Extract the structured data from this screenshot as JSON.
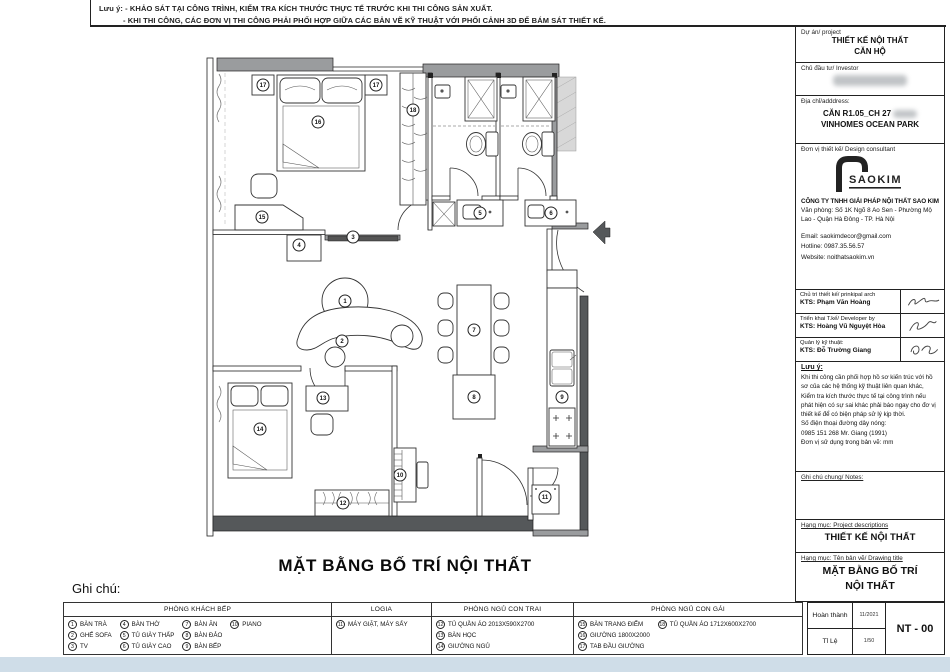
{
  "notes": {
    "line1": "Lưu ý: - KHẢO SÁT TẠI CÔNG TRÌNH, KIỂM TRA KÍCH THƯỚC THỰC TẾ TRƯỚC KHI THI CÔNG SẢN XUẤT.",
    "line2": "- KHI THI CÔNG, CÁC ĐƠN VỊ THI CÔNG PHẢI PHỐI HỢP GIỮA CÁC BẢN VẼ KỸ THUẬT VỚI PHỐI CẢNH 3D ĐỂ BÁM SÁT THIẾT KẾ."
  },
  "plan": {
    "title": "MẶT BẰNG BỐ TRÍ NỘI THẤT",
    "callouts": [
      {
        "n": "1",
        "x": 150,
        "y": 253
      },
      {
        "n": "2",
        "x": 147,
        "y": 293
      },
      {
        "n": "3",
        "x": 158,
        "y": 189
      },
      {
        "n": "4",
        "x": 104,
        "y": 197
      },
      {
        "n": "5",
        "x": 285,
        "y": 165
      },
      {
        "n": "6",
        "x": 356,
        "y": 165
      },
      {
        "n": "7",
        "x": 279,
        "y": 282
      },
      {
        "n": "8",
        "x": 279,
        "y": 349
      },
      {
        "n": "9",
        "x": 367,
        "y": 349
      },
      {
        "n": "10",
        "x": 205,
        "y": 427
      },
      {
        "n": "11",
        "x": 350,
        "y": 449
      },
      {
        "n": "12",
        "x": 148,
        "y": 455
      },
      {
        "n": "13",
        "x": 128,
        "y": 350
      },
      {
        "n": "14",
        "x": 65,
        "y": 381
      },
      {
        "n": "15",
        "x": 67,
        "y": 169
      },
      {
        "n": "16",
        "x": 123,
        "y": 74
      },
      {
        "n": "17",
        "x": 68,
        "y": 37
      },
      {
        "n": "17",
        "x": 181,
        "y": 37
      },
      {
        "n": "18",
        "x": 218,
        "y": 62
      }
    ]
  },
  "legend": {
    "title": "Ghi chú:",
    "groups": [
      {
        "header": "PHÒNG KHÁCH BẾP",
        "cols": [
          [
            {
              "n": "1",
              "label": "BÀN TRÀ"
            },
            {
              "n": "2",
              "label": "GHẾ SOFA"
            },
            {
              "n": "3",
              "label": "TV"
            }
          ],
          [
            {
              "n": "4",
              "label": "BÀN THỜ"
            },
            {
              "n": "5",
              "label": "TỦ GIÀY THẤP"
            },
            {
              "n": "6",
              "label": "TỦ GIÀY CAO"
            }
          ],
          [
            {
              "n": "7",
              "label": "BÀN ĂN"
            },
            {
              "n": "8",
              "label": "BÀN ĐẢO"
            },
            {
              "n": "9",
              "label": "BÀN BẾP"
            }
          ],
          [
            {
              "n": "10",
              "label": "PIANO"
            }
          ]
        ]
      },
      {
        "header": "LOGIA",
        "cols": [
          [
            {
              "n": "11",
              "label": "MÁY GIẶT, MÁY SẤY"
            }
          ]
        ]
      },
      {
        "header": "PHÒNG NGỦ CON TRAI",
        "cols": [
          [
            {
              "n": "12",
              "label": "TỦ QUẦN ÁO 2013X590X2700"
            },
            {
              "n": "13",
              "label": "BÀN HỌC"
            },
            {
              "n": "14",
              "label": "GIƯỜNG NGỦ"
            }
          ]
        ]
      },
      {
        "header": "PHÒNG NGỦ CON GÁI",
        "cols": [
          [
            {
              "n": "15",
              "label": "BÀN TRANG ĐIỂM"
            },
            {
              "n": "16",
              "label": "GIƯỜNG 1800X2000"
            },
            {
              "n": "17",
              "label": "TAB ĐẦU GIƯỜNG"
            }
          ],
          [
            {
              "n": "18",
              "label": "TỦ QUẦN ÁO 1712X600X2700"
            }
          ]
        ]
      }
    ]
  },
  "titleblock": {
    "project_label": "Dự án/ project",
    "project_line1": "THIẾT KẾ NỘI THẤT",
    "project_line2": "CĂN HỘ",
    "investor_label": "Chủ đầu tư/ Investor",
    "address_label": "Địa chỉ/adddress:",
    "address_line1": "CĂN R1.05_CH 27",
    "address_line2": "VINHOMES OCEAN PARK",
    "consultant_label": "Đơn vị thiết kế/ Design consultant",
    "logo_text": "SAOKIM",
    "company": "CÔNG TY TNHH GIẢI PHÁP NỘI THẤT SAO KIM",
    "office": "Văn phòng: Số 1K Ngõ 8 Ao Sen - Phường Mộ Lao - Quận Hà Đông - TP. Hà Nội",
    "email": "Email: saokimdecor@gmail.com",
    "hotline": "Hotline: 0987.35.56.57",
    "website": "Website: noithatsaokim.vn",
    "arch1_label": "Chủ trì thiết kế/ prinkipal arch",
    "arch1_name": "KTS: Phạm Văn Hoàng",
    "arch2_label": "Triển khai T.kế/ Developer by",
    "arch2_name": "KTS: Hoàng Vũ Nguyệt Hòa",
    "arch3_label": "Quản lý kỹ thuật:",
    "arch3_name": "KTS: Đỗ Trường Giang",
    "note_title": "Lưu ý:",
    "note_body": "Khi thi công cần phối hợp hồ sơ kiến trúc với hồ sơ của các hệ thống kỹ thuật liên quan khác, Kiểm tra kích thước thực tế tại công trình nếu phát hiện có sự sai khác phải báo ngay cho đơ vị thiết kế để có biện pháp sử lý kịp thời.",
    "note_phone1": "Số điện thoại đường dây nóng:",
    "note_phone2": "0985 151 268  Mr. Giang (1991)",
    "note_unit": "Đơn vị sử dụng trong bản vẽ: mm",
    "general_note_label": "Ghi chú chung/ Notes:",
    "descriptions_label": "Hạng mục: Project descriptions",
    "descriptions_value": "THIẾT KẾ NỘI THẤT",
    "drawing_title_label": "Hạng mục: Tên bản vẽ/ Drawing title",
    "drawing_title_line1": "MẶT BẰNG BỐ TRÍ",
    "drawing_title_line2": "NỘI THẤT",
    "completed_label": "Hoàn thành",
    "completed_value": "11/2021",
    "scale_label": "Tỉ Lệ",
    "scale_value": "1/50",
    "sheet_no": "NT - 00"
  },
  "colors": {
    "wall_gray": "#9a9c9e",
    "wall_dark": "#55585a",
    "canvas_blue": "#cfdde8"
  }
}
